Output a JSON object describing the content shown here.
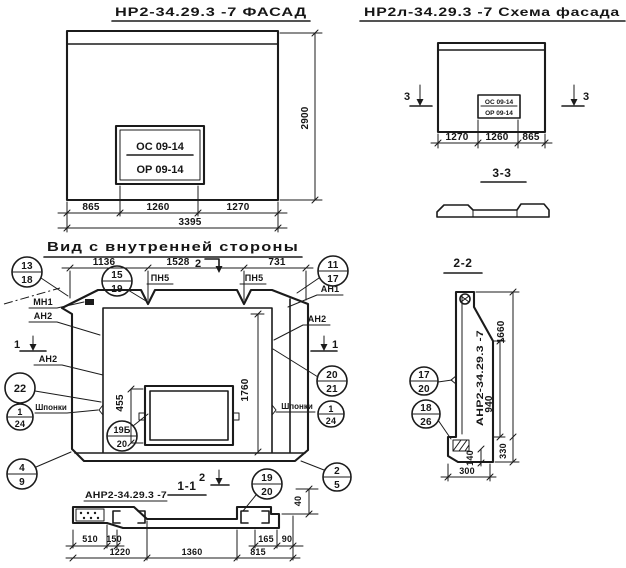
{
  "facade": {
    "title": "НР2-34.29.3 -7 ФАСАД",
    "stamp_line1": "ОС 09-14",
    "stamp_line2": "ОР 09-14",
    "dim_height": "2900",
    "dim_a": "865",
    "dim_b": "1260",
    "dim_c": "1270",
    "dim_total": "3395"
  },
  "schema": {
    "title": "НР2л-34.29.3 -7 Схема фасада",
    "stamp_line1": "ОС 09-14",
    "stamp_line2": "ОР 09-14",
    "marker_left": "3",
    "marker_right": "3",
    "dim_a": "1270",
    "dim_b": "1260",
    "dim_c": "865",
    "section_title": "3-3"
  },
  "inner_view": {
    "title": "Вид с внутренней стороны",
    "dim_a": "1136",
    "dim_b": "1528",
    "dim_c": "731",
    "marker_top": "2",
    "marker_bottom": "2",
    "marker_left": "1",
    "marker_right": "1",
    "label_pn5_left": "ПН5",
    "label_pn5_right": "ПН5",
    "label_mn1": "МН1",
    "label_an2_left1": "АН2",
    "label_an2_left2": "АН2",
    "label_an1": "АН1",
    "label_an2_right": "АН2",
    "label_keys_left": "Шпонки",
    "label_keys_right": "Шпонки",
    "dim_window": "455",
    "dim_opening": "1760",
    "circles": {
      "c13_18": {
        "top": "13",
        "bottom": "18"
      },
      "c15_19": {
        "top": "15",
        "bottom": "19"
      },
      "c11_17": {
        "top": "11",
        "bottom": "17"
      },
      "c22": {
        "value": "22"
      },
      "c20_21": {
        "top": "20",
        "bottom": "21"
      },
      "c1_24_left": {
        "top": "1",
        "bottom": "24"
      },
      "c1_24_right": {
        "top": "1",
        "bottom": "24"
      },
      "c19b_20": {
        "top": "19Б",
        "bottom": "20"
      },
      "c4_9": {
        "top": "4",
        "bottom": "9"
      },
      "c2_5": {
        "top": "2",
        "bottom": "5"
      },
      "c19_20": {
        "top": "19",
        "bottom": "20"
      }
    }
  },
  "section_1_1": {
    "title": "1-1",
    "label": "АНР2-34.29.3 -7",
    "dim_510": "510",
    "dim_150": "150",
    "dim_1220": "1220",
    "dim_1360": "1360",
    "dim_165": "165",
    "dim_90": "90",
    "dim_815": "815",
    "dim_40": "40"
  },
  "section_2_2": {
    "title": "2-2",
    "label_vertical": "АНР2-34.29.3 -7",
    "dim_1660": "1660",
    "dim_940": "940",
    "dim_330": "330",
    "dim_140": "140",
    "dim_300": "300",
    "circles": {
      "c17_20": {
        "top": "17",
        "bottom": "20"
      },
      "c18_26": {
        "top": "18",
        "bottom": "26"
      }
    }
  }
}
